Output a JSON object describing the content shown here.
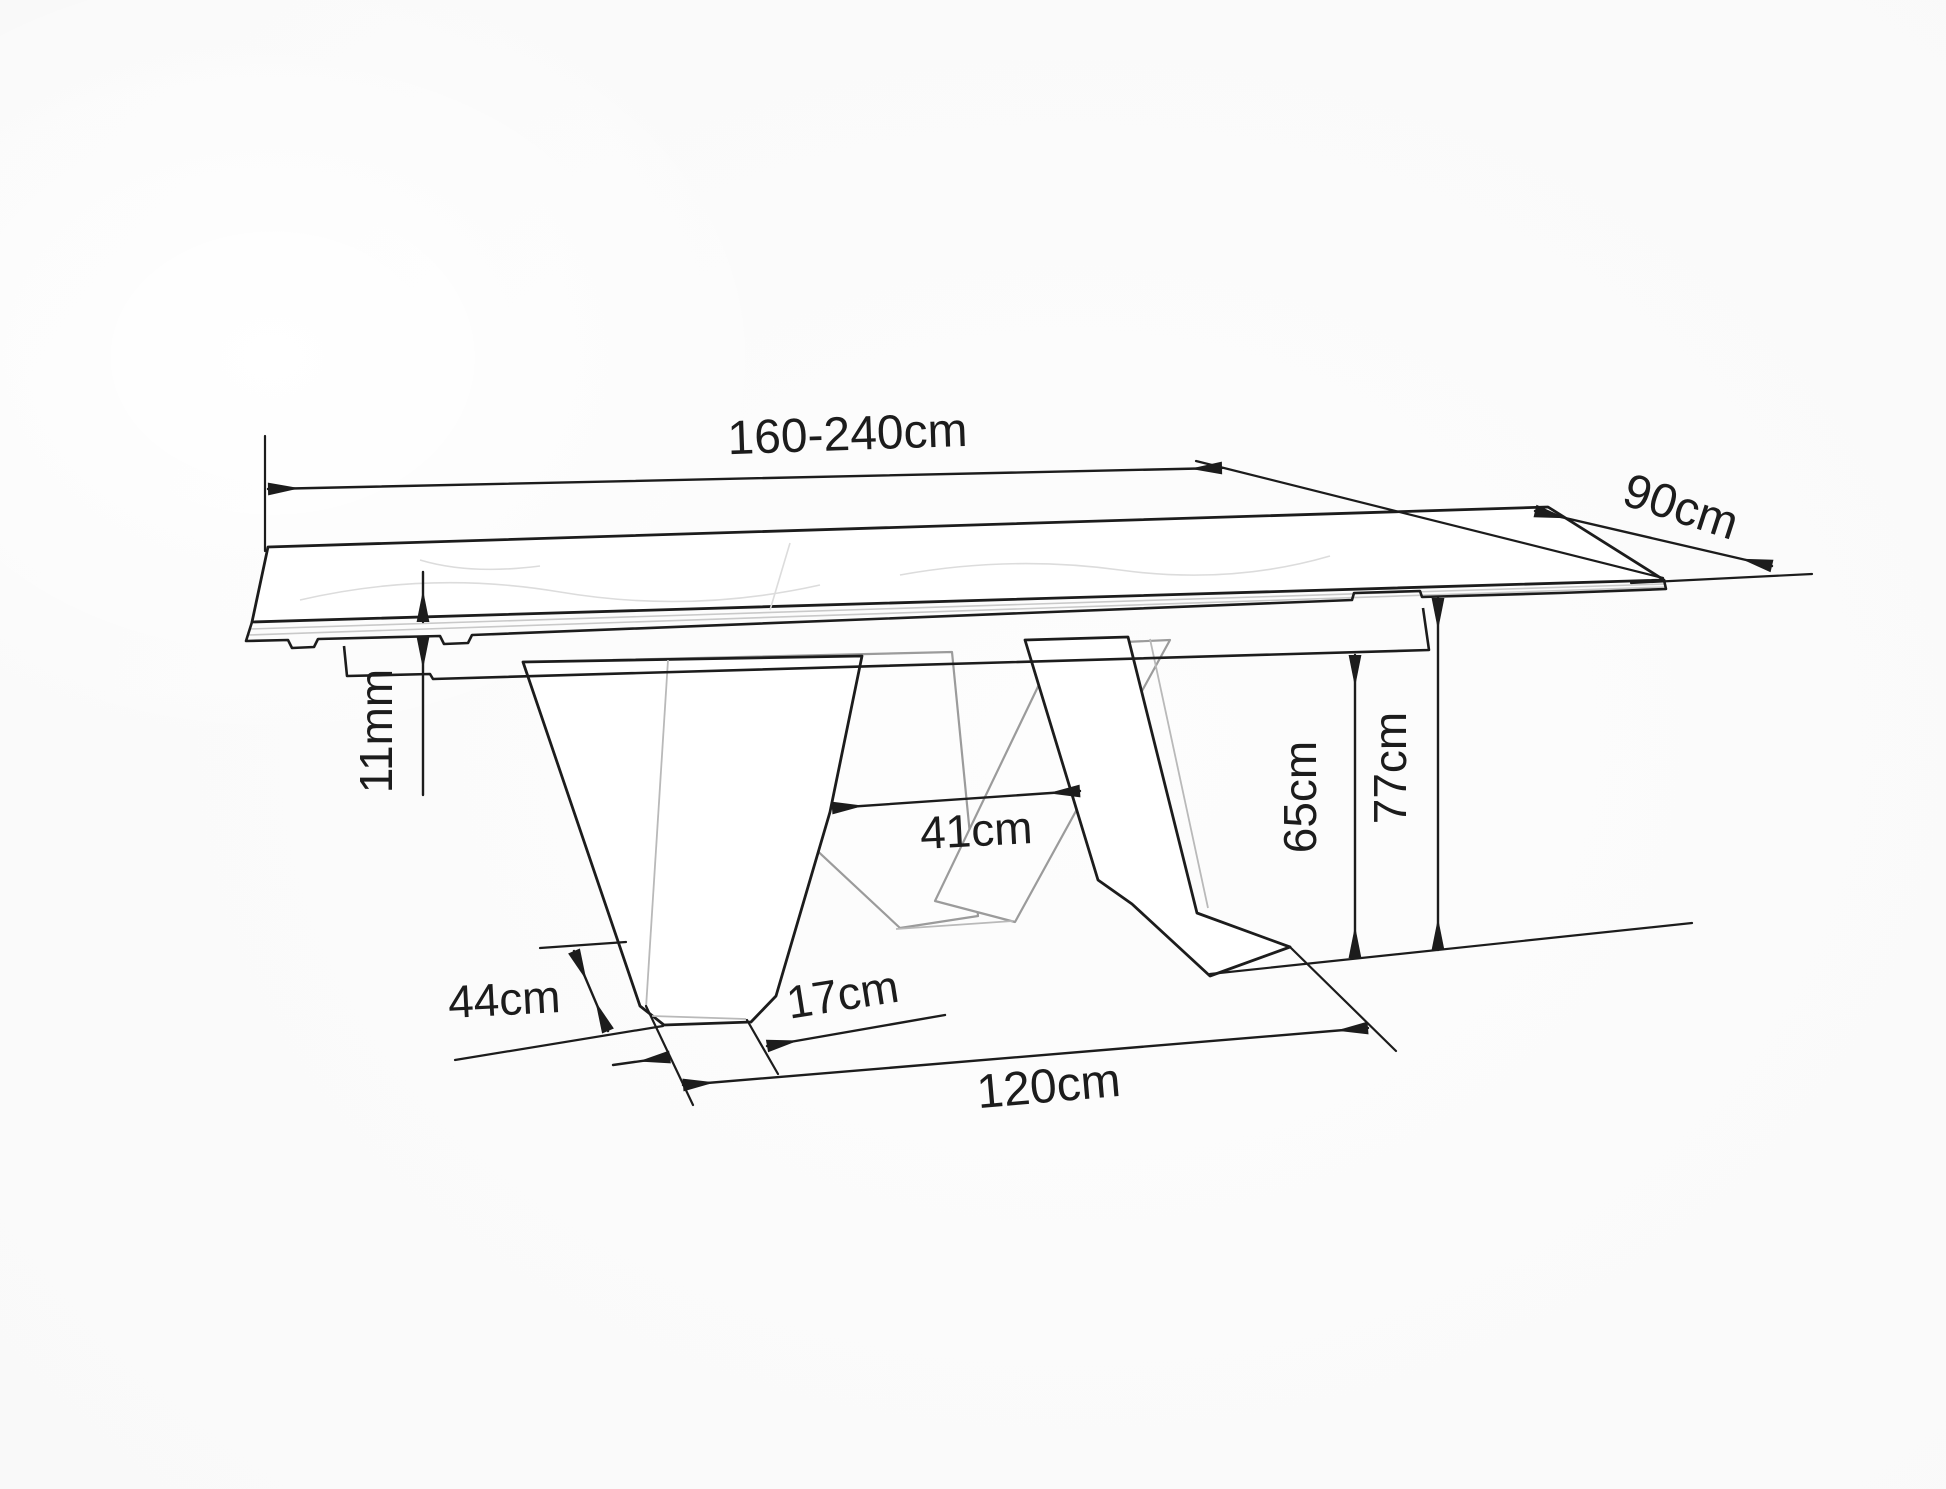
{
  "diagram": {
    "kind": "furniture-dimension-drawing",
    "subject": "extendable-dining-table-perspective-outline",
    "background_color": "#fafafa",
    "line_color": "#1c1c1c",
    "secondary_line_color": "#9b9b9b",
    "dimensions": {
      "table_length": {
        "label": "160-240cm"
      },
      "table_depth": {
        "label": "90cm"
      },
      "top_thickness": {
        "label": "11mm"
      },
      "leg_gap": {
        "label": "41cm"
      },
      "underframe_clearance": {
        "label": "65cm"
      },
      "table_height": {
        "label": "77cm"
      },
      "foot_length": {
        "label": "44cm"
      },
      "foot_width": {
        "label": "17cm"
      },
      "base_length": {
        "label": "120cm"
      }
    }
  }
}
